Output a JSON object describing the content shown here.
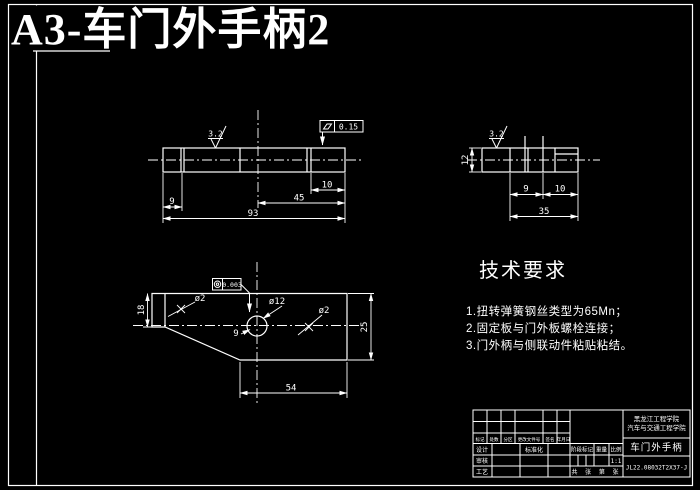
{
  "title": "A3-车门外手柄2",
  "colors": {
    "background": "#000000",
    "line": "#ffffff",
    "title": "#ffff00"
  },
  "side_view": {
    "roughness": "3.2",
    "flatness_symbol": "flatness",
    "flatness_value": "0.15",
    "dim_10": "10",
    "dim_45": "45",
    "dim_9": "9",
    "dim_93": "93"
  },
  "end_view": {
    "roughness": "3.2",
    "dim_12": "12",
    "dim_9": "9",
    "dim_10": "10",
    "dim_35": "35"
  },
  "top_view": {
    "concentricity_symbol": "concentricity",
    "concentricity_value": "0.003",
    "dia_12": "ø12",
    "dia_2_left": "ø2",
    "dia_2_right": "ø2",
    "dim_9": "9",
    "dim_18": "18",
    "dim_25": "25",
    "dim_54": "54"
  },
  "tech_requirements": {
    "heading": "技术要求",
    "item_1": "1.扭转弹簧钢丝类型为65Mn；",
    "item_2": "2.固定板与门外板螺栓连接；",
    "item_3": "3.门外柄与侧联动件粘贴粘结。"
  },
  "title_block": {
    "school_line1": "黑龙江工程学院",
    "school_line2": "汽车与交通工程学院",
    "part_name": "车门外手柄",
    "drawing_no": "JL22.08032T2X37-J",
    "label_mark": "标记",
    "label_count": "处数",
    "label_zone": "分区",
    "label_change_doc": "更改文件号",
    "label_sign": "签名",
    "label_date": "年月日",
    "label_design": "设计",
    "label_standardize": "标准化",
    "label_check": "审核",
    "label_process": "工艺",
    "label_stage": "阶段标记",
    "label_weight": "重量",
    "label_scale": "比例",
    "scale_value": "1:1",
    "sheet_info": "共 张 第 张"
  }
}
